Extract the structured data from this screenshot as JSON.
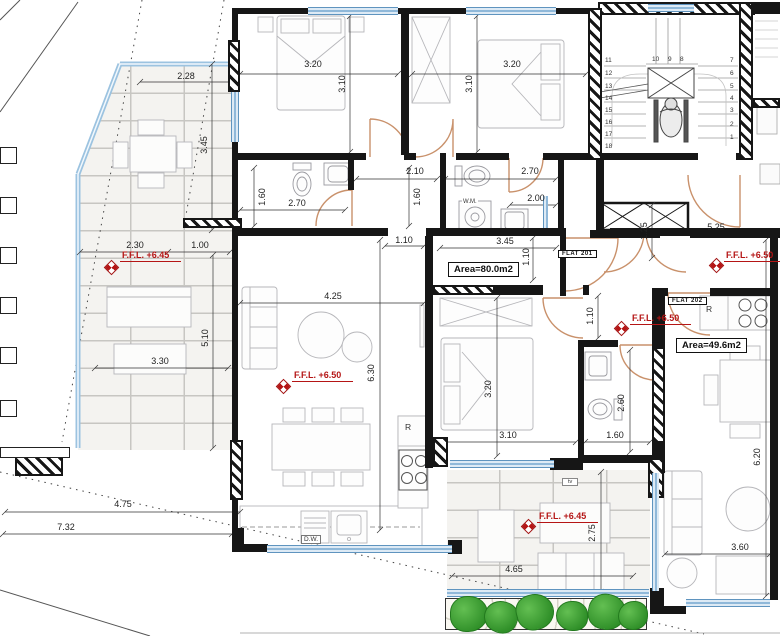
{
  "dims": {
    "terrace1_w": "2.28",
    "terrace1_h": "3.45",
    "bed1_w": "3.20",
    "bed1_h": "3.10",
    "bed2_w": "3.20",
    "bed2_h": "3.10",
    "hall_top_w": "2.10",
    "wc2_top_w": "2.70",
    "bath1_h": "1.60",
    "bath1_w": "2.70",
    "hall_h": "1.60",
    "wc2_h": "2.00",
    "wc2_w": "3.45",
    "hall_opening_w": "1.10",
    "entry201_h": "1.10",
    "terrace2_w1": "2.30",
    "terrace2_w2": "1.00",
    "terrace2_w3": "3.30",
    "terrace2_h": "5.10",
    "living1_w": "4.25",
    "living1_h": "6.30",
    "landing_w": "5.25",
    "landing_h": "1.25",
    "corr202_h": "1.10",
    "bed3_h": "3.20",
    "bed3_w": "3.10",
    "bath3_h": "2.60",
    "bath3_w": "1.60",
    "living2_h": "6.20",
    "living2_w": "3.60",
    "terrace3_w": "4.65",
    "terrace3_h": "2.75",
    "site_w1": "4.75",
    "site_w2": "7.32"
  },
  "levels": {
    "ffl_645": "F.F.L. +6.45",
    "ffl_650": "F.F.L. +6.50"
  },
  "flats": {
    "f201": {
      "name": "FLAT  201",
      "area": "Area=80.0m2"
    },
    "f202": {
      "name": "FLAT  202",
      "area": "Area=49.6m2"
    }
  },
  "labels": {
    "wm": "W.M.",
    "dw": "D.W.",
    "fridge": "R",
    "tv": "tv"
  },
  "stairs": {
    "left": [
      "11",
      "12",
      "13",
      "14",
      "15",
      "16",
      "17",
      "18"
    ],
    "top": [
      "10",
      "9",
      "8"
    ],
    "right": [
      "7",
      "6",
      "5",
      "4",
      "3",
      "2",
      "1"
    ]
  },
  "colors": {
    "wall": "#161616",
    "window": "#8fb8d9",
    "door": "#c9916b",
    "level_red": "#b51515",
    "plant": "#2f8f28"
  }
}
